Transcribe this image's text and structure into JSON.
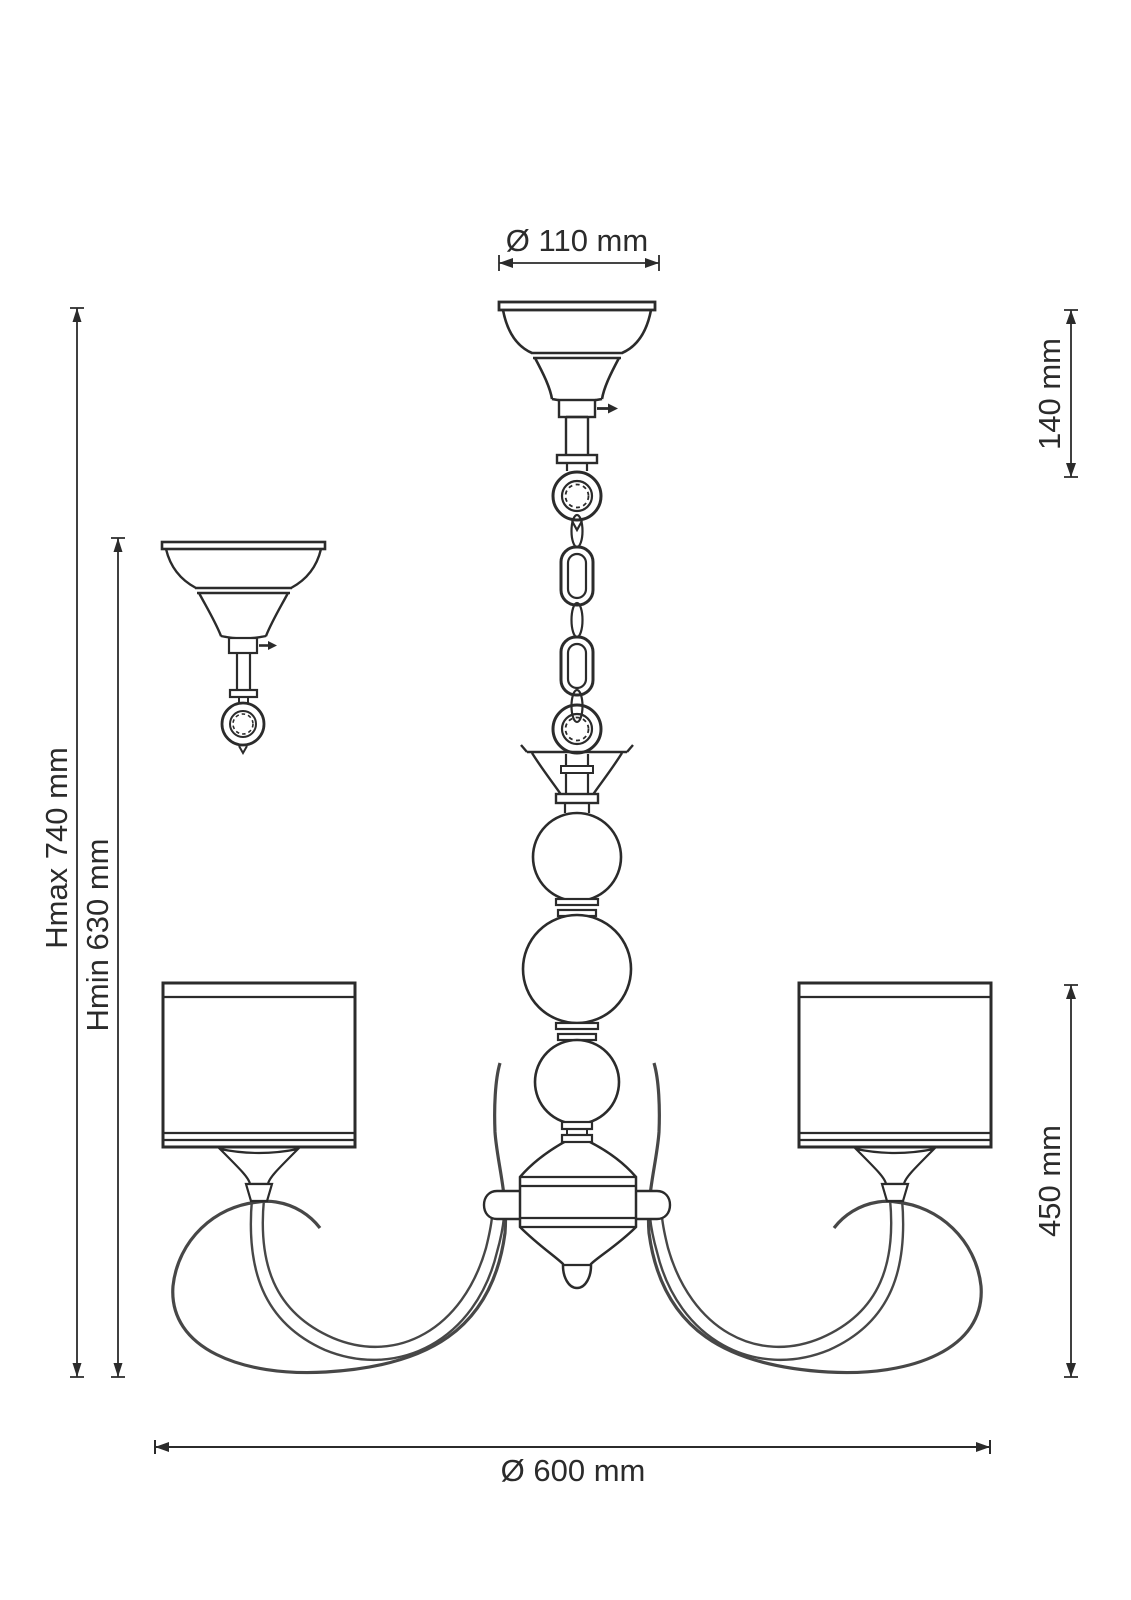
{
  "dimensions": {
    "canopy_diameter": "Ø 110 mm",
    "canopy_height": "140 mm",
    "max_height": "Hmax 740 mm",
    "min_height": "Hmin 630 mm",
    "body_height": "450 mm",
    "overall_diameter": "Ø 600 mm"
  },
  "colors": {
    "line": "#2b2b2b",
    "line_soft": "#474747",
    "background": "#ffffff"
  }
}
